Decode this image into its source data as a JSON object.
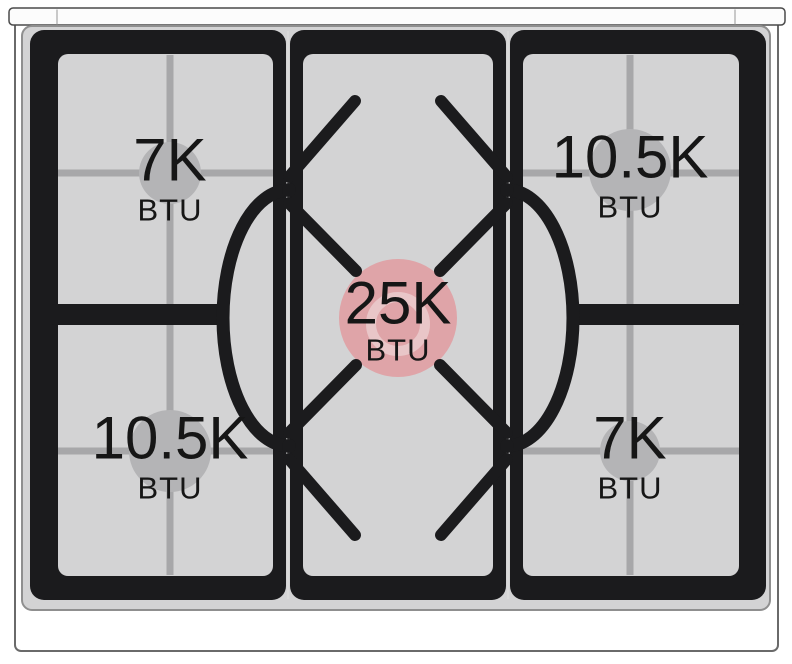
{
  "diagram": {
    "type": "gas-range-cooktop-burner-power-diagram",
    "burner_count": 5
  },
  "burners": {
    "top_left": {
      "value": "7K",
      "unit": "BTU"
    },
    "top_right": {
      "value": "10.5K",
      "unit": "BTU"
    },
    "center": {
      "value": "25K",
      "unit": "BTU"
    },
    "bottom_left": {
      "value": "10.5K",
      "unit": "BTU"
    },
    "bottom_right": {
      "value": "7K",
      "unit": "BTU"
    }
  },
  "colors": {
    "surface_gray": "#d3d3d4",
    "grate_black": "#1b1b1d",
    "cross_gray": "#a7a7a9",
    "burner_marker_gray": "#b4b4b6",
    "burner_marker_highlight_pink": "#dfa4a8",
    "burner_ring_light_pink": "#e9c6c8",
    "text_color": "#161616"
  }
}
